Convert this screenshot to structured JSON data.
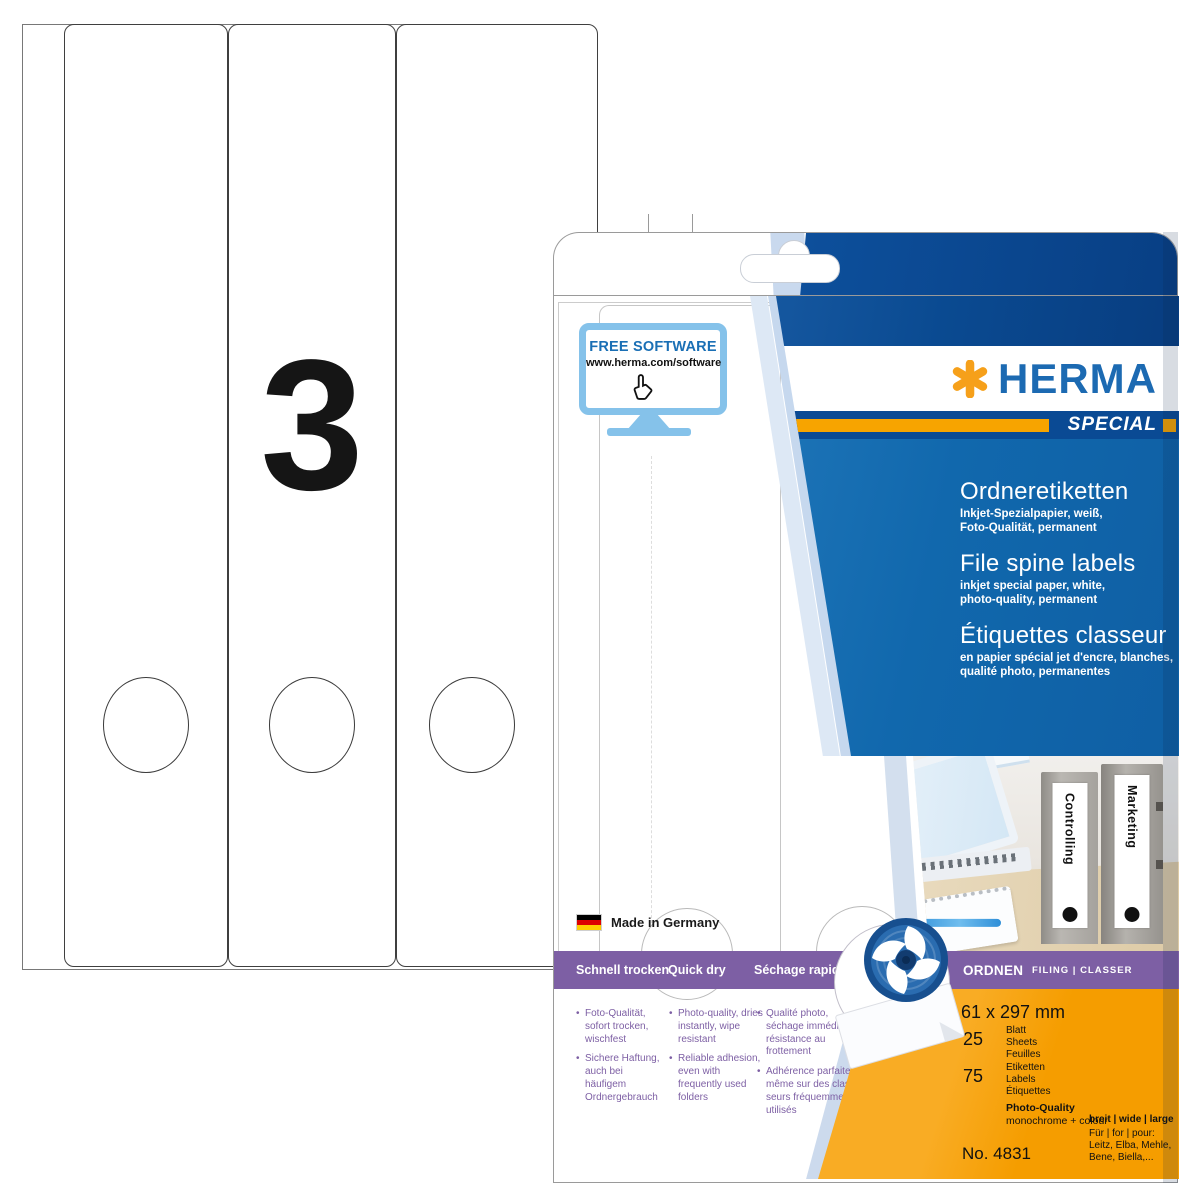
{
  "colors": {
    "herma_blue": "#1c6ab2",
    "navy": "#0a4a94",
    "mid_blue": "#1168ad",
    "orange": "#f7a400",
    "orange_panel": "#f59d00",
    "purple": "#7d5fa4",
    "monitor_blue": "#85c2ea"
  },
  "sheet": {
    "big_number": "3"
  },
  "box": {
    "free_software": {
      "title": "FREE SOFTWARE",
      "url": "www.herma.com/software"
    },
    "made_in": "Made in Germany",
    "brand": {
      "name": "HERMA",
      "special": "SPECIAL"
    },
    "titles": {
      "de": {
        "title": "Ordneretiketten",
        "sub": "Inkjet-Spezialpapier, weiß,\nFoto-Qualität, permanent"
      },
      "en": {
        "title": "File spine labels",
        "sub": "inkjet special paper, white,\nphoto-quality, permanent"
      },
      "fr": {
        "title": "Étiquettes classeur",
        "sub": "en papier spécial jet d'encre, blanches,\nqualité photo, permanentes"
      }
    },
    "photo": {
      "binder1": "Controlling",
      "binder2": "Marketing"
    },
    "quickdry": {
      "de": "Schnell trocken",
      "en": "Quick dry",
      "fr": "Séchage rapide"
    },
    "category": {
      "main": "ORDNEN",
      "rest": "FILING | CLASSER"
    },
    "bullets": {
      "de": [
        "Foto-Qualität, sofort trocken, wischfest",
        "Sichere Haftung, auch bei häufigem Ordnergebrauch"
      ],
      "en": [
        "Photo-quality, dries instantly, wipe resistant",
        "Reliable adhesion, even with frequently used folders"
      ],
      "fr": [
        "Qualité photo, séchage immédiat, résistance au frottement",
        "Adhérence parfaite même sur des clas- seurs fréquemment utilisés"
      ]
    },
    "specs": {
      "size": "61 x 297 mm",
      "sheets_count": "25",
      "sheets_label": "Blatt\nSheets\nFeuilles",
      "labels_count": "75",
      "labels_label": "Etiketten\nLabels\nÉtiquettes",
      "quality_title": "Photo-Quality",
      "quality_sub": "monochrome + colour",
      "ink": "Ink",
      "order_no": "No. 4831",
      "mini_number": "3",
      "width_info": "breit | wide | large",
      "for_info": "Für | for | pour:\nLeitz, Elba, Mehle,\nBene, Biella,..."
    }
  }
}
